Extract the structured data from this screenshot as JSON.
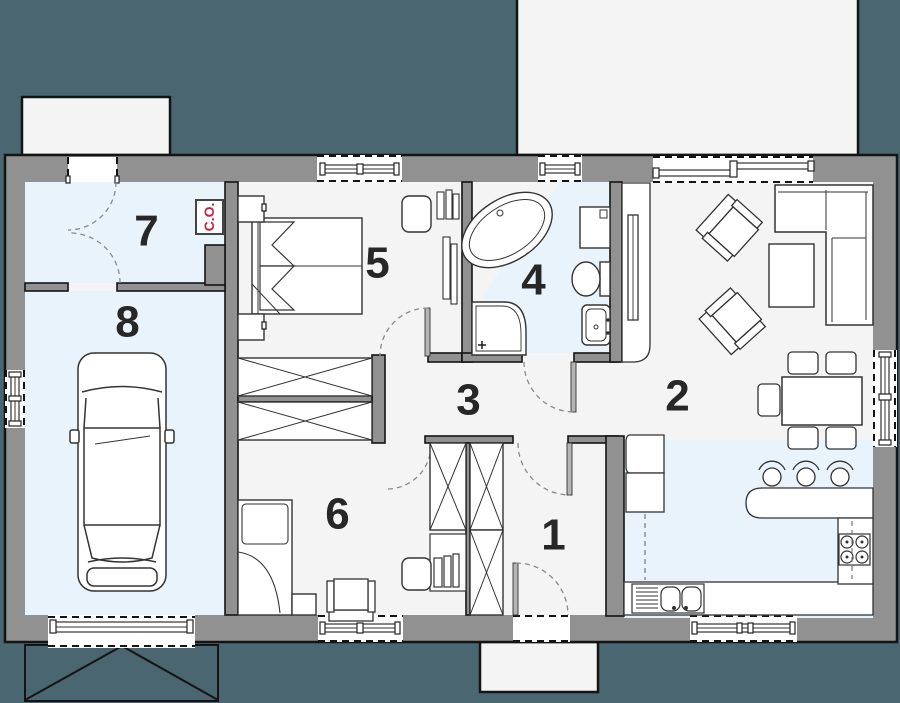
{
  "plan": {
    "rooms": [
      {
        "number": "1"
      },
      {
        "number": "2"
      },
      {
        "number": "3"
      },
      {
        "number": "4"
      },
      {
        "number": "5"
      },
      {
        "number": "6"
      },
      {
        "number": "7"
      },
      {
        "number": "8"
      }
    ],
    "boiler_label": "C.O.",
    "colors": {
      "outside": "#4a6671",
      "wall": "#919191",
      "outline": "#141414",
      "floor": "#f4f4f5",
      "floor_tiled": "#e9f3fb",
      "furniture_outline": "#333333",
      "accent_red": "#c81f44",
      "label_color": "#272727"
    }
  }
}
